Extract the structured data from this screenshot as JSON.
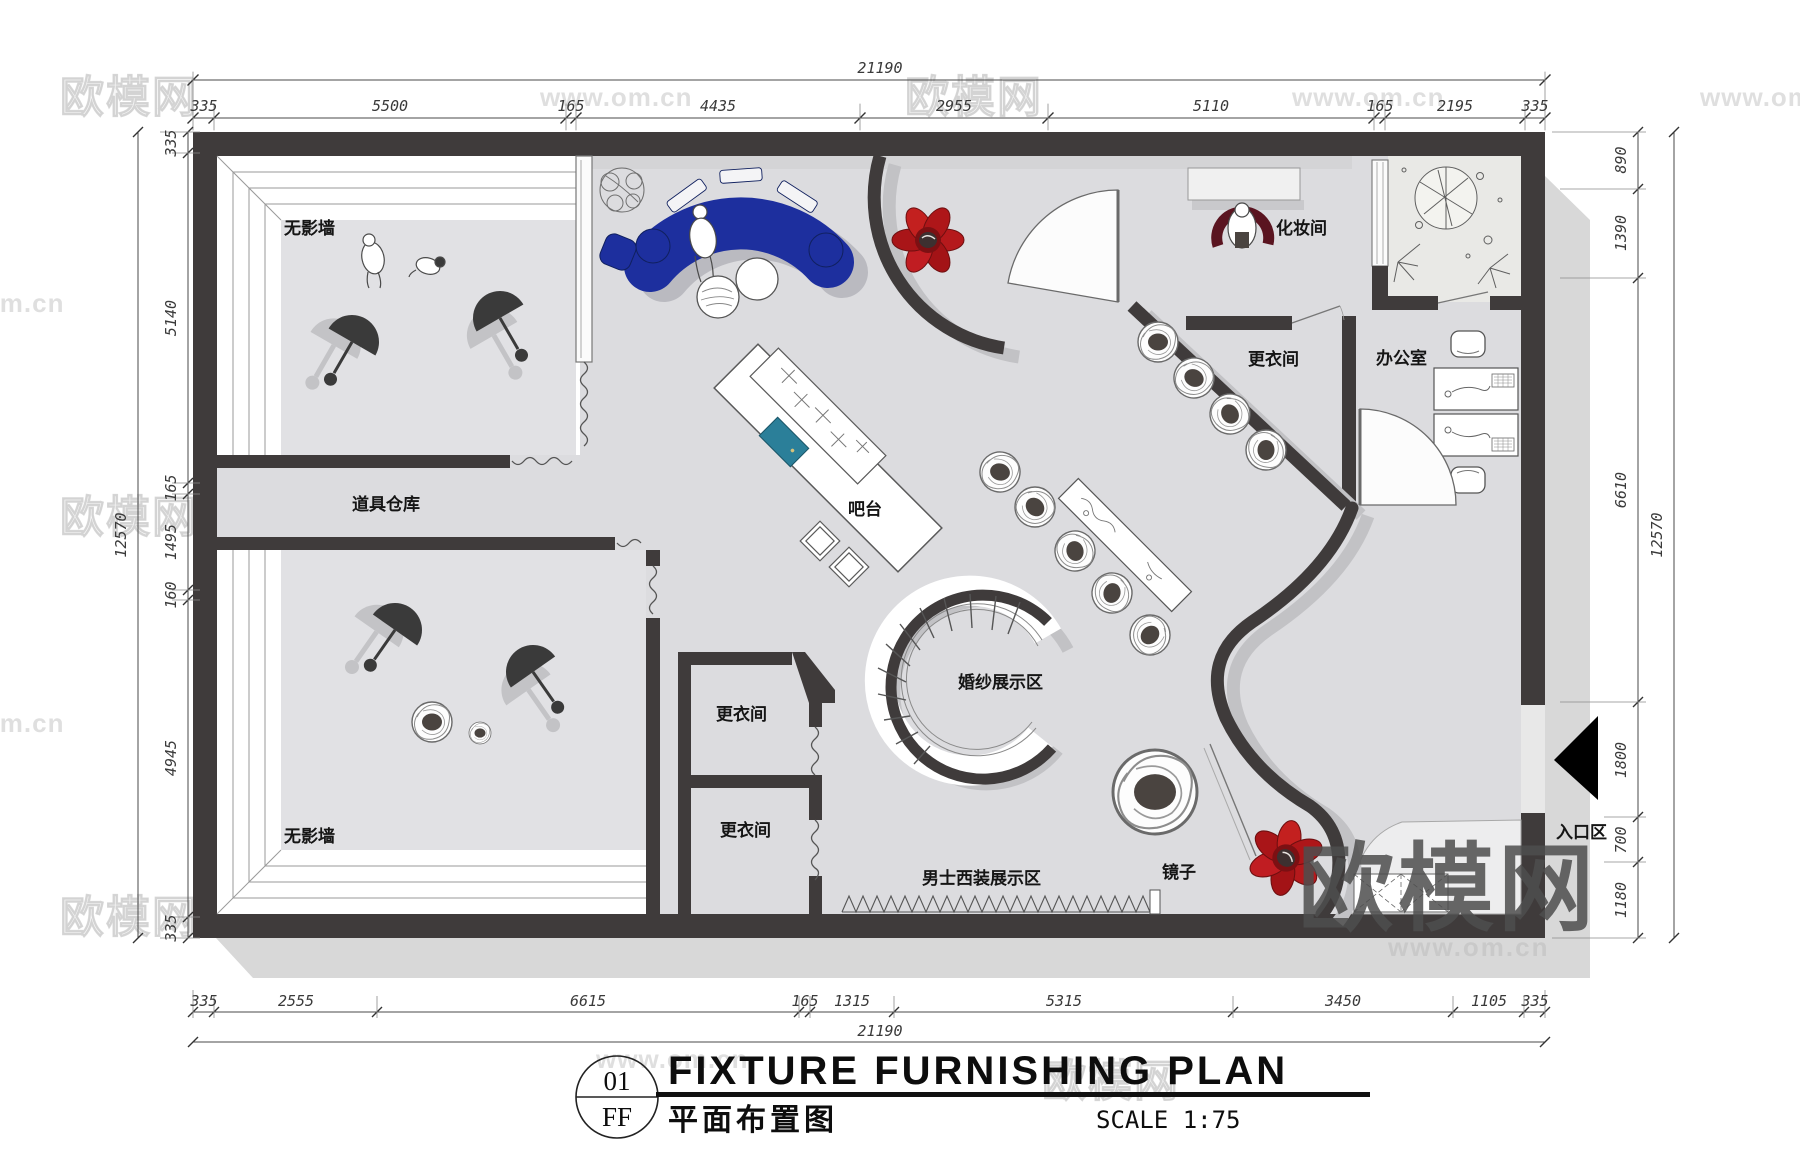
{
  "watermark": {
    "brand": "欧模网",
    "url": "www.om.cn"
  },
  "title_block": {
    "drawing_number": "01",
    "level": "FF",
    "title": "FIXTURE FURNISHING PLAN",
    "title_cn": "平面布置图",
    "scale_label": "SCALE 1:75"
  },
  "rooms": {
    "shadowless_wall": "无影墙",
    "prop_storage": "道具仓库",
    "fitting_room": "更衣间",
    "makeup_room": "化妆间",
    "office": "办公室",
    "bar_counter": "吧台",
    "wedding_dress_display": "婚纱展示区",
    "mens_suit_display": "男士西装展示区",
    "mirror": "镜子",
    "entrance": "入口区"
  },
  "dimensions": {
    "top": {
      "overall": "21190",
      "segments": [
        "335",
        "5500",
        "165",
        "4435",
        "2955",
        "5110",
        "165",
        "2195",
        "335"
      ]
    },
    "bottom": {
      "overall": "21190",
      "segments": [
        "335",
        "2555",
        "6615",
        "165",
        "1315",
        "5315",
        "3450",
        "1105",
        "335"
      ]
    },
    "left": {
      "overall": "12570",
      "segments": [
        "335",
        "5140",
        "165",
        "1495",
        "160",
        "4945",
        "335"
      ]
    },
    "right": {
      "overall": "12570",
      "segments": [
        "890",
        "1390",
        "6610",
        "1800",
        "700",
        "1180"
      ]
    }
  },
  "colors": {
    "wall": "#3f3b3b",
    "floor": "#dcdcdf",
    "sofa_blue": "#1d2f9e",
    "chair_red": "#b5191c",
    "sink_teal": "#2b7f99",
    "shadow": "#c6c6c9"
  }
}
